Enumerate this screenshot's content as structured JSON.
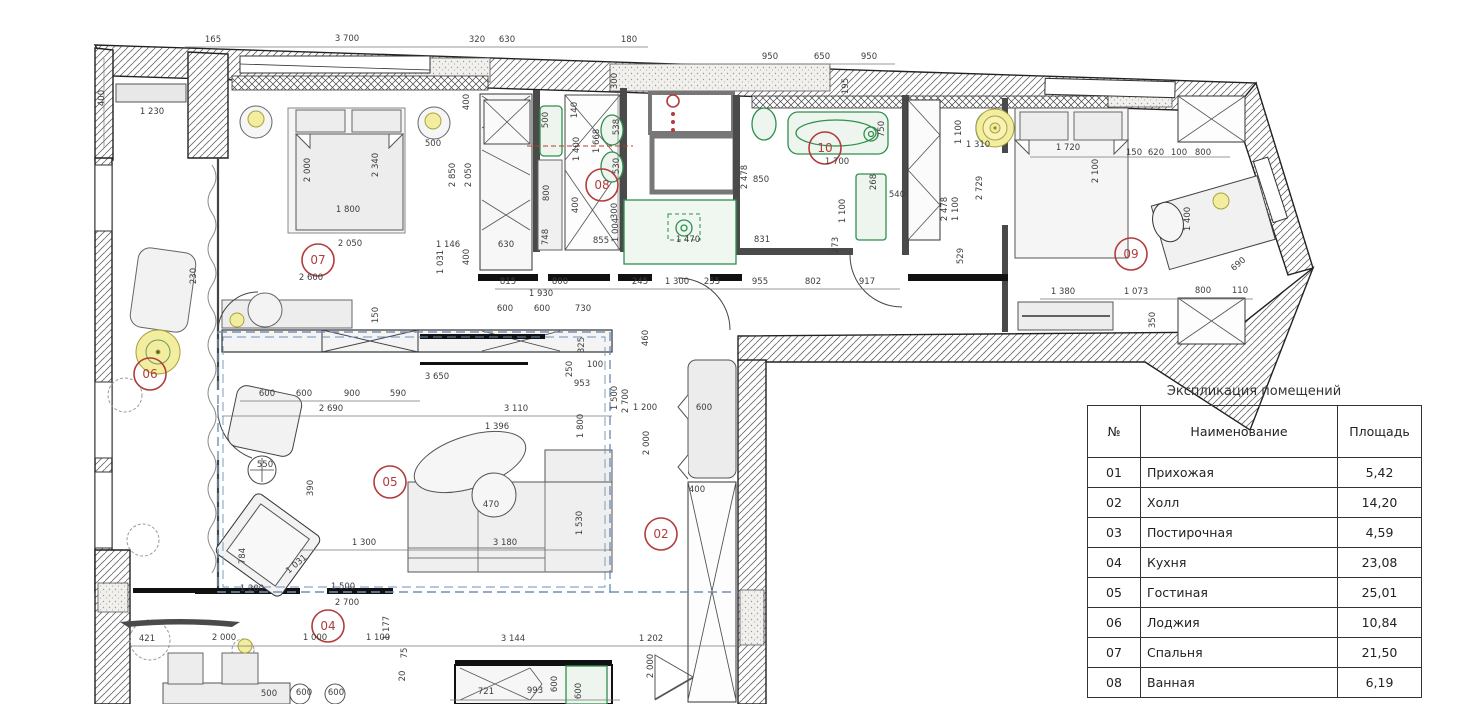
{
  "table": {
    "title": "Экспликация помещений",
    "headers": [
      "№",
      "Наименование",
      "Площадь"
    ],
    "rows": [
      [
        "01",
        "Прихожая",
        "5,42"
      ],
      [
        "02",
        "Холл",
        "14,20"
      ],
      [
        "03",
        "Постирочная",
        "4,59"
      ],
      [
        "04",
        "Кухня",
        "23,08"
      ],
      [
        "05",
        "Гостиная",
        "25,01"
      ],
      [
        "06",
        "Лоджия",
        "10,84"
      ],
      [
        "07",
        "Спальня",
        "21,50"
      ],
      [
        "08",
        "Ванная",
        "6,19"
      ]
    ]
  },
  "plan": {
    "rooms": [
      {
        "id": "07",
        "x": 318,
        "y": 260
      },
      {
        "id": "08",
        "x": 602,
        "y": 185
      },
      {
        "id": "10",
        "x": 825,
        "y": 148
      },
      {
        "id": "09",
        "x": 1131,
        "y": 254
      },
      {
        "id": "06",
        "x": 150,
        "y": 374
      },
      {
        "id": "05",
        "x": 390,
        "y": 482
      },
      {
        "id": "02",
        "x": 661,
        "y": 534
      },
      {
        "id": "04",
        "x": 328,
        "y": 626
      }
    ],
    "dimensions": [
      [
        "165",
        213,
        42,
        0
      ],
      [
        "3 700",
        347,
        41,
        0
      ],
      [
        "320",
        477,
        42,
        0
      ],
      [
        "630",
        507,
        42,
        0
      ],
      [
        "180",
        629,
        42,
        0
      ],
      [
        "950",
        770,
        59,
        0
      ],
      [
        "650",
        822,
        59,
        0
      ],
      [
        "950",
        869,
        59,
        0
      ],
      [
        "195",
        848,
        86,
        1
      ],
      [
        "400",
        104,
        98,
        1
      ],
      [
        "1 230",
        152,
        114,
        0
      ],
      [
        "2 000",
        310,
        170,
        1
      ],
      [
        "2 340",
        378,
        165,
        1
      ],
      [
        "500",
        433,
        146,
        0
      ],
      [
        "1 800",
        348,
        212,
        0
      ],
      [
        "2 050",
        350,
        246,
        0
      ],
      [
        "1 146",
        448,
        247,
        0
      ],
      [
        "630",
        506,
        247,
        0
      ],
      [
        "2 600",
        311,
        280,
        0
      ],
      [
        "230",
        196,
        276,
        1
      ],
      [
        "1 031",
        443,
        262,
        1
      ],
      [
        "150",
        378,
        315,
        1
      ],
      [
        "2 850",
        455,
        175,
        1
      ],
      [
        "2 050",
        471,
        175,
        1
      ],
      [
        "400",
        469,
        102,
        1
      ],
      [
        "400",
        469,
        257,
        1
      ],
      [
        "500",
        548,
        120,
        1
      ],
      [
        "140",
        577,
        110,
        1
      ],
      [
        "1 400",
        579,
        149,
        1
      ],
      [
        "1 668",
        599,
        141,
        1
      ],
      [
        "538",
        619,
        127,
        1
      ],
      [
        "530",
        619,
        166,
        1
      ],
      [
        "300",
        617,
        81,
        1
      ],
      [
        "800",
        549,
        193,
        1
      ],
      [
        "400",
        578,
        205,
        1
      ],
      [
        "748",
        548,
        237,
        1
      ],
      [
        "855",
        601,
        243,
        0
      ],
      [
        "300",
        617,
        211,
        1
      ],
      [
        "1 004",
        618,
        230,
        1
      ],
      [
        "1 470",
        688,
        242,
        0
      ],
      [
        "815",
        508,
        284,
        0
      ],
      [
        "800",
        560,
        284,
        0
      ],
      [
        "245",
        640,
        284,
        0
      ],
      [
        "1 300",
        677,
        284,
        0
      ],
      [
        "255",
        712,
        284,
        0
      ],
      [
        "955",
        760,
        284,
        0
      ],
      [
        "802",
        813,
        284,
        0
      ],
      [
        "917",
        867,
        284,
        0
      ],
      [
        "1 930",
        541,
        296,
        0
      ],
      [
        "600",
        505,
        311,
        0
      ],
      [
        "600",
        542,
        311,
        0
      ],
      [
        "730",
        583,
        311,
        0
      ],
      [
        "460",
        648,
        338,
        1
      ],
      [
        "1 200",
        645,
        410,
        0
      ],
      [
        "600",
        704,
        410,
        0
      ],
      [
        "2 000",
        649,
        443,
        1
      ],
      [
        "400",
        697,
        492,
        0
      ],
      [
        "1 500",
        617,
        398,
        1
      ],
      [
        "2 700",
        628,
        401,
        1
      ],
      [
        "1 200",
        252,
        591,
        0
      ],
      [
        "1 500",
        343,
        589,
        0
      ],
      [
        "2 700",
        347,
        605,
        0
      ],
      [
        "850",
        761,
        182,
        0
      ],
      [
        "2 478",
        747,
        177,
        1
      ],
      [
        "268",
        876,
        182,
        1
      ],
      [
        "540",
        897,
        197,
        0
      ],
      [
        "1 100",
        845,
        211,
        1
      ],
      [
        "273",
        838,
        245,
        1
      ],
      [
        "750",
        884,
        129,
        1
      ],
      [
        "1 700",
        837,
        164,
        0
      ],
      [
        "831",
        762,
        242,
        0
      ],
      [
        "2 478",
        947,
        209,
        1
      ],
      [
        "1 100",
        961,
        132,
        1
      ],
      [
        "1 310",
        978,
        147,
        0
      ],
      [
        "2 729",
        982,
        188,
        1
      ],
      [
        "1 100",
        958,
        209,
        1
      ],
      [
        "529",
        963,
        256,
        1
      ],
      [
        "1 720",
        1068,
        150,
        0
      ],
      [
        "2 100",
        1098,
        171,
        1
      ],
      [
        "150",
        1134,
        155,
        0
      ],
      [
        "620",
        1156,
        155,
        0
      ],
      [
        "100",
        1179,
        155,
        0
      ],
      [
        "800",
        1203,
        155,
        0
      ],
      [
        "1 400",
        1190,
        219,
        1
      ],
      [
        "690",
        1240,
        266,
        2
      ],
      [
        "1 380",
        1063,
        294,
        0
      ],
      [
        "1 073",
        1136,
        294,
        0
      ],
      [
        "800",
        1203,
        293,
        0
      ],
      [
        "110",
        1240,
        293,
        0
      ],
      [
        "350",
        1155,
        320,
        1
      ],
      [
        "3 650",
        437,
        379,
        0
      ],
      [
        "953",
        582,
        386,
        0
      ],
      [
        "250",
        572,
        369,
        1
      ],
      [
        "100",
        595,
        367,
        0
      ],
      [
        "325",
        584,
        345,
        1
      ],
      [
        "600",
        267,
        396,
        0
      ],
      [
        "600",
        304,
        396,
        0
      ],
      [
        "900",
        352,
        396,
        0
      ],
      [
        "590",
        398,
        396,
        0
      ],
      [
        "2 690",
        331,
        411,
        0
      ],
      [
        "3 110",
        516,
        411,
        0
      ],
      [
        "1 396",
        497,
        429,
        0
      ],
      [
        "1 800",
        583,
        426,
        1
      ],
      [
        "550",
        265,
        467,
        0
      ],
      [
        "390",
        313,
        488,
        1
      ],
      [
        "470",
        491,
        507,
        0
      ],
      [
        "1 300",
        364,
        545,
        0
      ],
      [
        "3 180",
        505,
        545,
        0
      ],
      [
        "1 530",
        582,
        523,
        1
      ],
      [
        "784",
        245,
        556,
        1
      ],
      [
        "1 031",
        298,
        566,
        2
      ],
      [
        "421",
        147,
        641,
        0
      ],
      [
        "2 000",
        224,
        640,
        0
      ],
      [
        "1 000",
        315,
        640,
        0
      ],
      [
        "1 100",
        378,
        640,
        0
      ],
      [
        "1 177",
        389,
        628,
        1
      ],
      [
        "75",
        407,
        653,
        1
      ],
      [
        "20",
        405,
        676,
        1
      ],
      [
        "500",
        269,
        696,
        0
      ],
      [
        "600",
        304,
        695,
        0
      ],
      [
        "600",
        336,
        695,
        0
      ],
      [
        "3 144",
        513,
        641,
        0
      ],
      [
        "1 202",
        651,
        641,
        0
      ],
      [
        "2 000",
        653,
        666,
        1
      ],
      [
        "721",
        486,
        694,
        0
      ],
      [
        "993",
        535,
        693,
        0
      ],
      [
        "600",
        557,
        684,
        1
      ],
      [
        "600",
        581,
        691,
        1
      ]
    ],
    "colors": {
      "marker_red": "#b23c3c",
      "fixture_green": "#2f8f4e",
      "light_yellow": "#f3eda0",
      "zone_blue": "#7191b8"
    }
  }
}
